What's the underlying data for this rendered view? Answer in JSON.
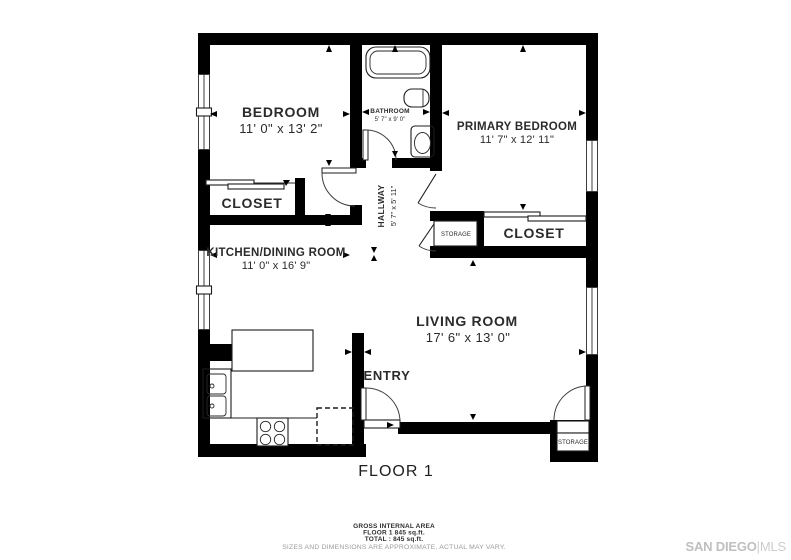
{
  "title": "FLOOR 1",
  "rooms": {
    "bedroom": {
      "name": "BEDROOM",
      "dims": "11' 0\" x 13' 2\""
    },
    "bathroom": {
      "name": "BATHROOM",
      "dims": "5' 7\" x 9' 0\""
    },
    "primary_bedroom": {
      "name": "PRIMARY BEDROOM",
      "dims": "11' 7\" x 12' 11\""
    },
    "closet_left": {
      "name": "CLOSET"
    },
    "closet_right": {
      "name": "CLOSET"
    },
    "hallway": {
      "name": "HALLWAY",
      "dims": "5' 7\" x 5' 11\""
    },
    "kitchen_dining": {
      "name": "KITCHEN/DINING ROOM",
      "dims": "11' 0\" x 16' 9\""
    },
    "living_room": {
      "name": "LIVING ROOM",
      "dims": "17' 6\" x 13' 0\""
    },
    "entry": {
      "name": "ENTRY"
    },
    "storage_hall": {
      "name": "STORAGE"
    },
    "storage_exterior": {
      "name": "STORAGE"
    }
  },
  "footer": {
    "area_heading": "GROSS INTERNAL AREA",
    "floor_area": "FLOOR 1 845 sq.ft.",
    "total_area": "TOTAL :  845 sq.ft.",
    "disclaimer": "SIZES AND DIMENSIONS ARE APPROXIMATE, ACTUAL MAY VARY."
  },
  "branding": {
    "primary": "SAN DIEGO",
    "separator": "|",
    "secondary": "MLS"
  },
  "colors": {
    "wall": "#000000",
    "label_text": "#2b2b2b",
    "disclaimer_text": "#9b9b9b",
    "brand_gray": "#c3c3c3",
    "background": "#ffffff"
  }
}
